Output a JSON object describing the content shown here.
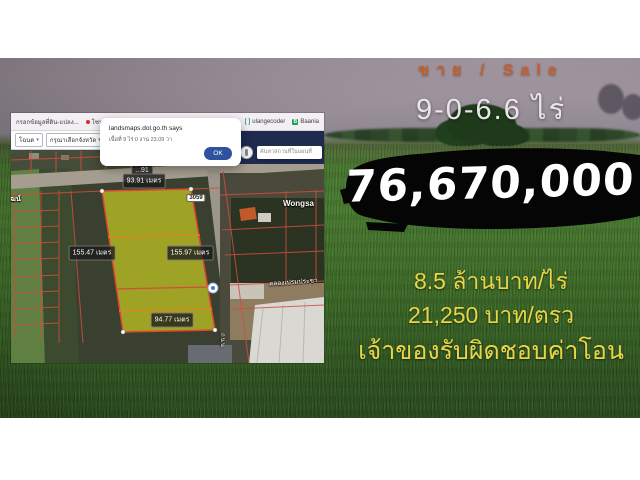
{
  "listing": {
    "sale_label": "ขาย / Sale",
    "area": "9-0-6.6 ไร่",
    "price": "76,670,000",
    "price_per_rai": "8.5  ล้านบาท/ไร่",
    "price_per_wah": "21,250  บาท/ตรว",
    "transfer_note": "เจ้าของรับผิดชอบค่าโอน",
    "colors": {
      "accent_orange": "#c35f2d",
      "accent_yellow": "#e8d647",
      "price_bg": "#050505",
      "price_text": "#ffffff"
    }
  },
  "map_window": {
    "bookmarks": {
      "items": [
        {
          "label": "กรอกข้อมูลที่ดิน-แปลง..."
        },
        {
          "label": "โซนสีผังเมือง โฉนด..."
        },
        {
          "label": "...town"
        },
        {
          "label": "ulangecoder"
        },
        {
          "label": "Baania"
        }
      ],
      "bracket_icon_glyph": "[ ]",
      "baania_icon_glyph": "B"
    },
    "toolbar": {
      "search_type": "โฉนด",
      "province": "กรุณาเลือกจังหวัด",
      "deed_no": "เลขที่โฉน",
      "chevron": "▾"
    },
    "dialog": {
      "title": "landsmaps.dol.go.th says",
      "message": "เนื้อที่ 9 ไร่ 0 งาน 23.09 วา",
      "ok_label": "OK"
    },
    "search": {
      "placeholder": "ค้นหาสถานที่ในแผนที่"
    },
    "labels": {
      "measure_top_partial": "...91",
      "measure_top": "93.91 เมตร",
      "measure_left": "155.47 เมตร",
      "measure_right": "155.97 เมตร",
      "measure_bottom": "94.77 เมตร",
      "route_shield": "3059",
      "place_right": "Wongsa",
      "place_left": "วพัฒน์",
      "canal": "คลองเปรมประชา",
      "road_vertical": "ถนน"
    },
    "map_colors": {
      "parcel_line": "#d84b3a",
      "highlight_plot": "#bcbf22",
      "navy_header": "#1e2b4e"
    }
  }
}
